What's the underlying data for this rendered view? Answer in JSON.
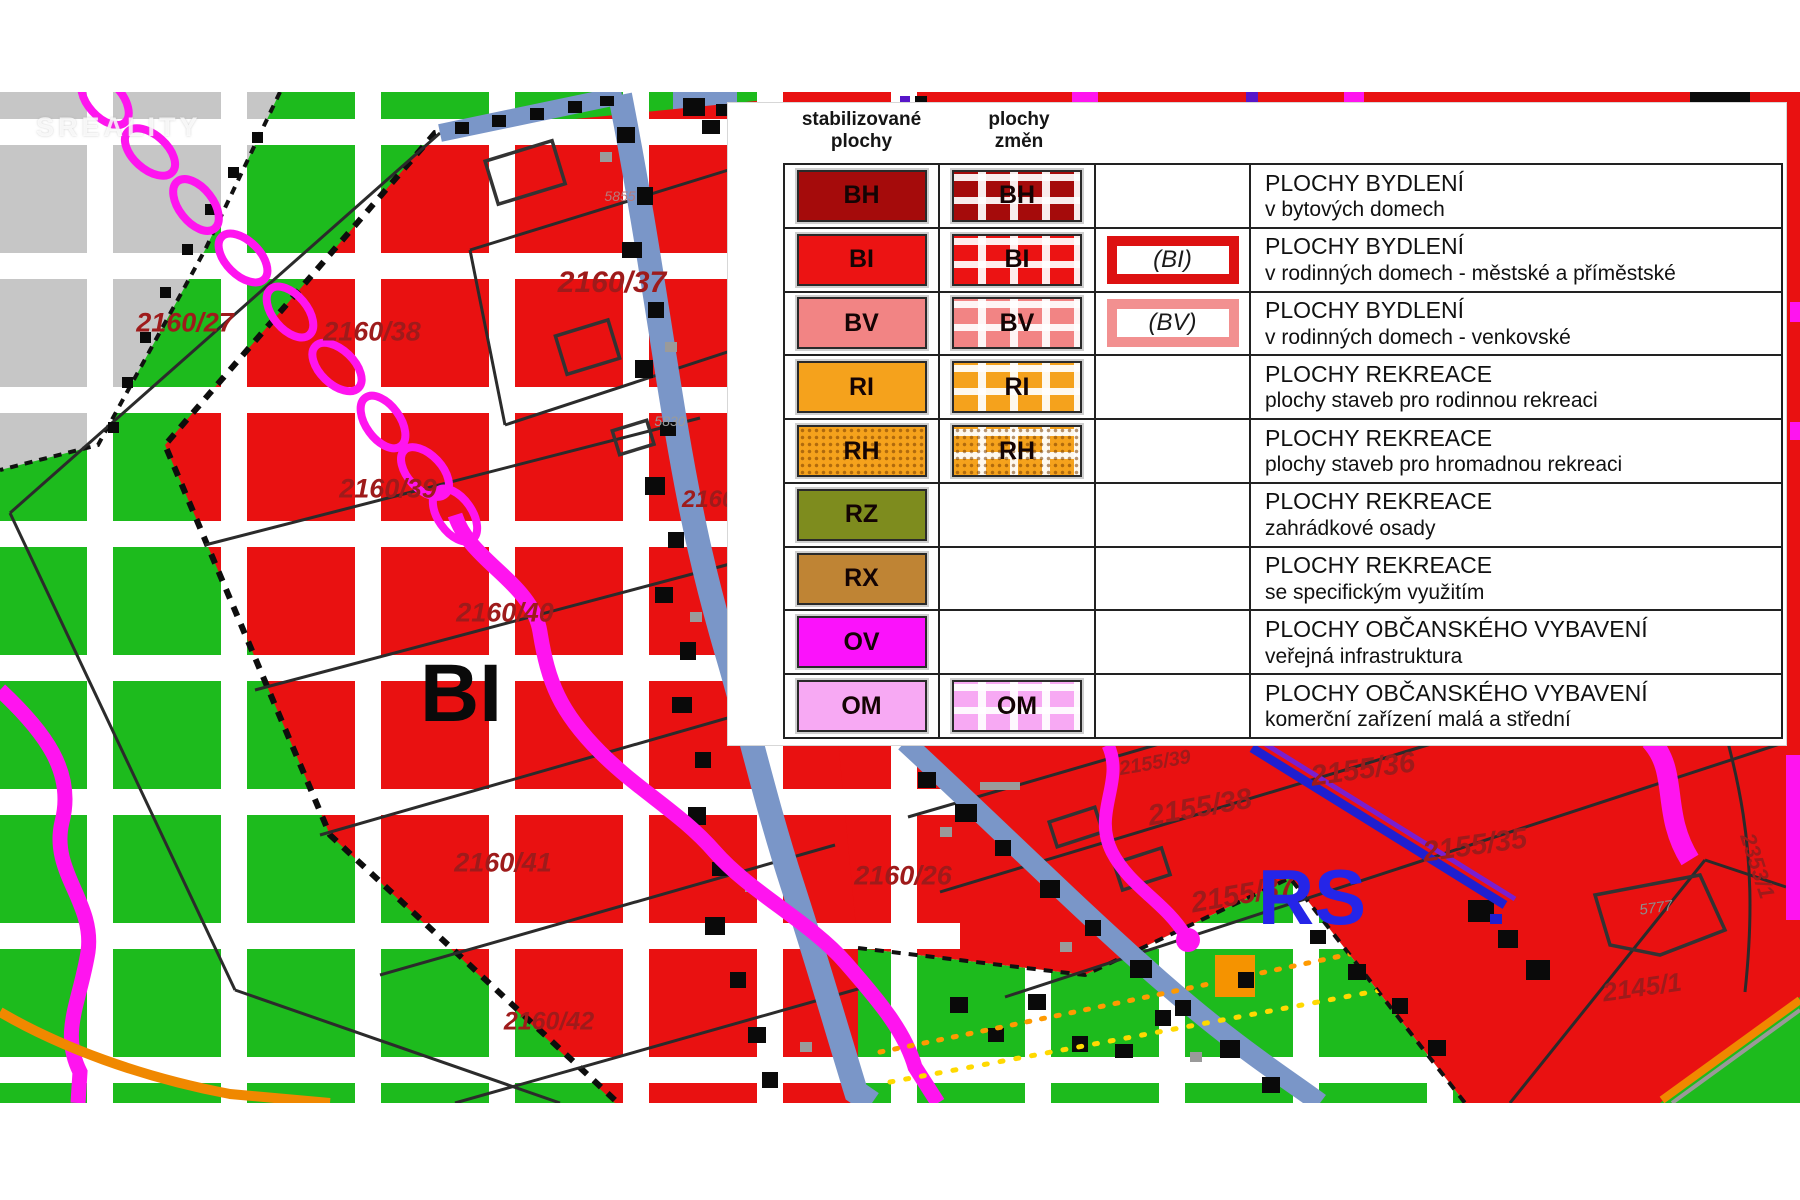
{
  "watermark": "SREALITY",
  "legend": {
    "header_stabilized": "stabilizované\nplochy",
    "header_changes": "plochy\nzměn",
    "rows": [
      {
        "code": "BH",
        "color": "#a50b0b",
        "changes": true,
        "dots": false,
        "outline": null,
        "outline_color": null,
        "line1": "PLOCHY BYDLENÍ",
        "line2": "v bytových domech"
      },
      {
        "code": "BI",
        "color": "#ec1313",
        "changes": true,
        "dots": false,
        "outline": "(BI)",
        "outline_color": "#dd1111",
        "line1": "PLOCHY BYDLENÍ",
        "line2": "v rodinných domech - městské a příměstské"
      },
      {
        "code": "BV",
        "color": "#f28484",
        "changes": true,
        "dots": false,
        "outline": "(BV)",
        "outline_color": "#f29090",
        "line1": "PLOCHY BYDLENÍ",
        "line2": "v rodinných domech - venkovské"
      },
      {
        "code": "RI",
        "color": "#f5a21c",
        "changes": true,
        "dots": false,
        "outline": null,
        "outline_color": null,
        "line1": "PLOCHY REKREACE",
        "line2": "plochy staveb pro rodinnou rekreaci"
      },
      {
        "code": "RH",
        "color": "#f5a21c",
        "changes": true,
        "dots": true,
        "outline": null,
        "outline_color": null,
        "line1": "PLOCHY REKREACE",
        "line2": "plochy staveb pro hromadnou rekreaci"
      },
      {
        "code": "RZ",
        "color": "#7e8c1e",
        "changes": false,
        "dots": false,
        "outline": null,
        "outline_color": null,
        "line1": "PLOCHY REKREACE",
        "line2": "zahrádkové osady"
      },
      {
        "code": "RX",
        "color": "#bf8434",
        "changes": false,
        "dots": false,
        "outline": null,
        "outline_color": null,
        "line1": "PLOCHY REKREACE",
        "line2": "se specifickým využitím"
      },
      {
        "code": "OV",
        "color": "#fb12fb",
        "changes": false,
        "dots": false,
        "outline": null,
        "outline_color": null,
        "line1": "PLOCHY OBČANSKÉHO VYBAVENÍ",
        "line2": "veřejná infrastruktura"
      },
      {
        "code": "OM",
        "color": "#f7a9f3",
        "changes": true,
        "dots": false,
        "outline": null,
        "outline_color": null,
        "line1": "PLOCHY OBČANSKÉHO VYBAVENÍ",
        "line2": "komerční zařízení malá a střední"
      }
    ]
  },
  "map": {
    "colors": {
      "green": "#1dbb1d",
      "red": "#e91111",
      "dark_red": "#a50b0b",
      "salmon": "#f28484",
      "orange": "#f5a21c",
      "olive": "#7e8c1e",
      "brown": "#bf8434",
      "magenta": "#fb12fb",
      "pink": "#f7a9f3",
      "road": "#7a96c8",
      "gray_area": "#c6c6c6",
      "chain": "#ff14ef",
      "label_text": "#9e1b1b",
      "blue_text": "#2525e8"
    },
    "labels": [
      {
        "text": "2160/27",
        "x": 185,
        "y": 323,
        "size": 27
      },
      {
        "text": "2160/38",
        "x": 372,
        "y": 332,
        "size": 27
      },
      {
        "text": "2160/37",
        "x": 612,
        "y": 283,
        "size": 30
      },
      {
        "text": "2160/39",
        "x": 388,
        "y": 489,
        "size": 27
      },
      {
        "text": "2160/40",
        "x": 505,
        "y": 613,
        "size": 27
      },
      {
        "text": "2160/41",
        "x": 503,
        "y": 863,
        "size": 27
      },
      {
        "text": "2160/42",
        "x": 549,
        "y": 1022,
        "size": 25
      },
      {
        "text": "2160/26",
        "x": 903,
        "y": 876,
        "size": 27
      },
      {
        "text": "2160/",
        "x": 712,
        "y": 500,
        "size": 24
      },
      {
        "text": "2155/39",
        "x": 1155,
        "y": 763,
        "size": 20,
        "rot": -10
      },
      {
        "text": "2155/38",
        "x": 1200,
        "y": 808,
        "size": 29,
        "rot": -10
      },
      {
        "text": "2155/37",
        "x": 1243,
        "y": 895,
        "size": 29,
        "rot": -10
      },
      {
        "text": "2155/36",
        "x": 1363,
        "y": 770,
        "size": 29,
        "rot": -8
      },
      {
        "text": "2155/35",
        "x": 1475,
        "y": 846,
        "size": 29,
        "rot": -8
      },
      {
        "text": "2145/1",
        "x": 1642,
        "y": 987,
        "size": 26,
        "rot": -8
      },
      {
        "text": "2353/1",
        "x": 1757,
        "y": 866,
        "size": 22,
        "rot": 72
      },
      {
        "text": "5777",
        "x": 1656,
        "y": 908,
        "size": 15,
        "rot": -8,
        "color": "#8d8d8d",
        "weight": 400
      },
      {
        "text": "5830",
        "x": 670,
        "y": 421,
        "size": 14,
        "color": "#9a9a9a",
        "weight": 400
      },
      {
        "text": "5855",
        "x": 620,
        "y": 196,
        "size": 14,
        "color": "#b87a7a",
        "weight": 400
      },
      {
        "text": "BI",
        "x": 461,
        "y": 694,
        "size": 82,
        "color": "#0a0a0a",
        "weight": 800,
        "italic": false
      },
      {
        "text": "RS",
        "x": 1312,
        "y": 897,
        "size": 78,
        "color": "#2525e8",
        "weight": 800,
        "italic": false
      }
    ]
  }
}
